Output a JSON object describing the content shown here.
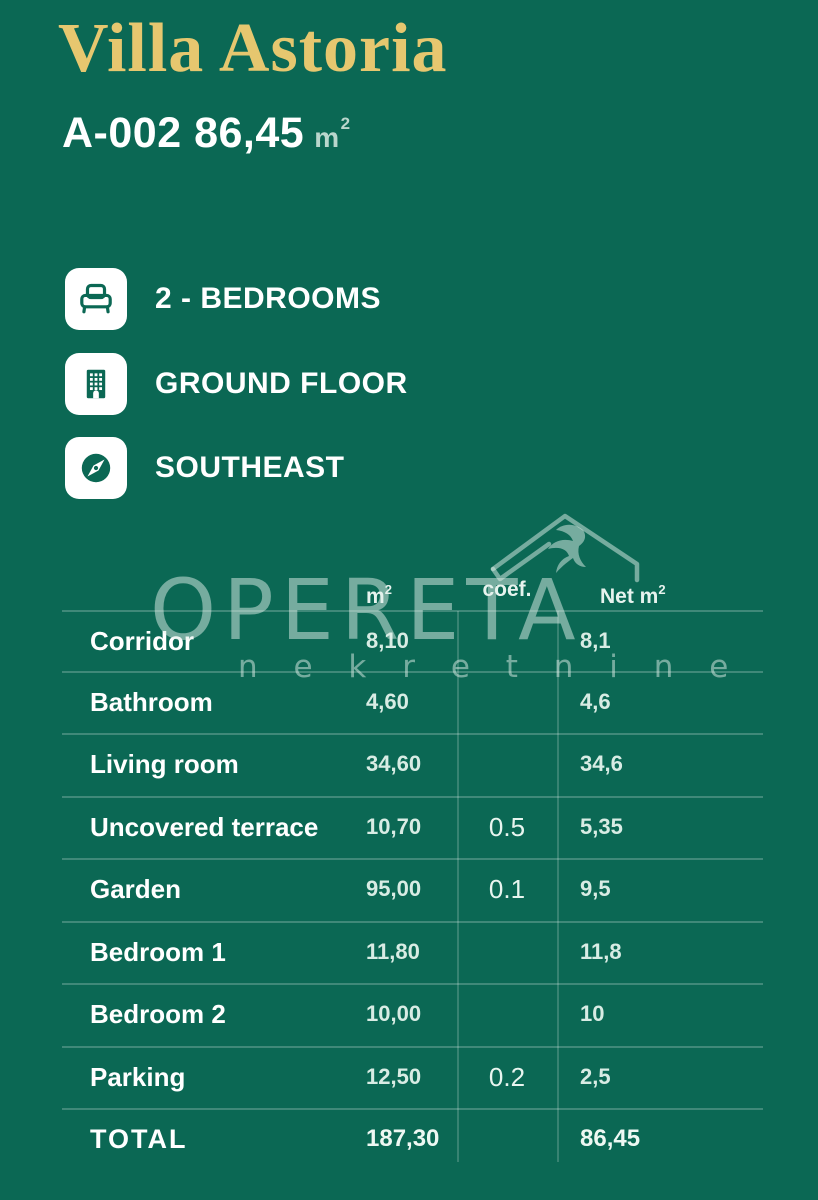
{
  "colors": {
    "background": "#0b6854",
    "title_gold": "#e6c76f",
    "text_white": "#ffffff",
    "value_mint": "#d8ece4",
    "watermark": "rgba(226,240,234,0.5)"
  },
  "header": {
    "title": "Villa Astoria",
    "unit_code": "A-002",
    "unit_area": "86,45",
    "unit_area_unit": "m",
    "unit_area_sup": "2"
  },
  "features": [
    {
      "icon": "bed-icon",
      "label": "2 - BEDROOMS"
    },
    {
      "icon": "building-icon",
      "label": "GROUND FLOOR"
    },
    {
      "icon": "compass-icon",
      "label": "SOUTHEAST"
    }
  ],
  "watermark": {
    "brand": "OPERETA",
    "subbrand": "n e k r e t n i n e",
    "logo": "roof-with-swallow-icon"
  },
  "table": {
    "headers": {
      "area_unit": "m",
      "area_sup": "2",
      "coef": "coef.",
      "net_prefix": "Net m",
      "net_sup": "2"
    },
    "rows": [
      {
        "label": "Corridor",
        "area": "8,10",
        "coef": "",
        "net": "8,1"
      },
      {
        "label": "Bathroom",
        "area": "4,60",
        "coef": "",
        "net": "4,6"
      },
      {
        "label": "Living room",
        "area": "34,60",
        "coef": "",
        "net": "34,6"
      },
      {
        "label": "Uncovered terrace",
        "area": "10,70",
        "coef": "0.5",
        "net": "5,35"
      },
      {
        "label": "Garden",
        "area": "95,00",
        "coef": "0.1",
        "net": "9,5"
      },
      {
        "label": "Bedroom 1",
        "area": "11,80",
        "coef": "",
        "net": "11,8"
      },
      {
        "label": "Bedroom 2",
        "area": "10,00",
        "coef": "",
        "net": "10"
      },
      {
        "label": "Parking",
        "area": "12,50",
        "coef": "0.2",
        "net": "2,5"
      },
      {
        "label": "TOTAL",
        "area": "187,30",
        "coef": "",
        "net": "86,45",
        "total": true
      }
    ]
  }
}
